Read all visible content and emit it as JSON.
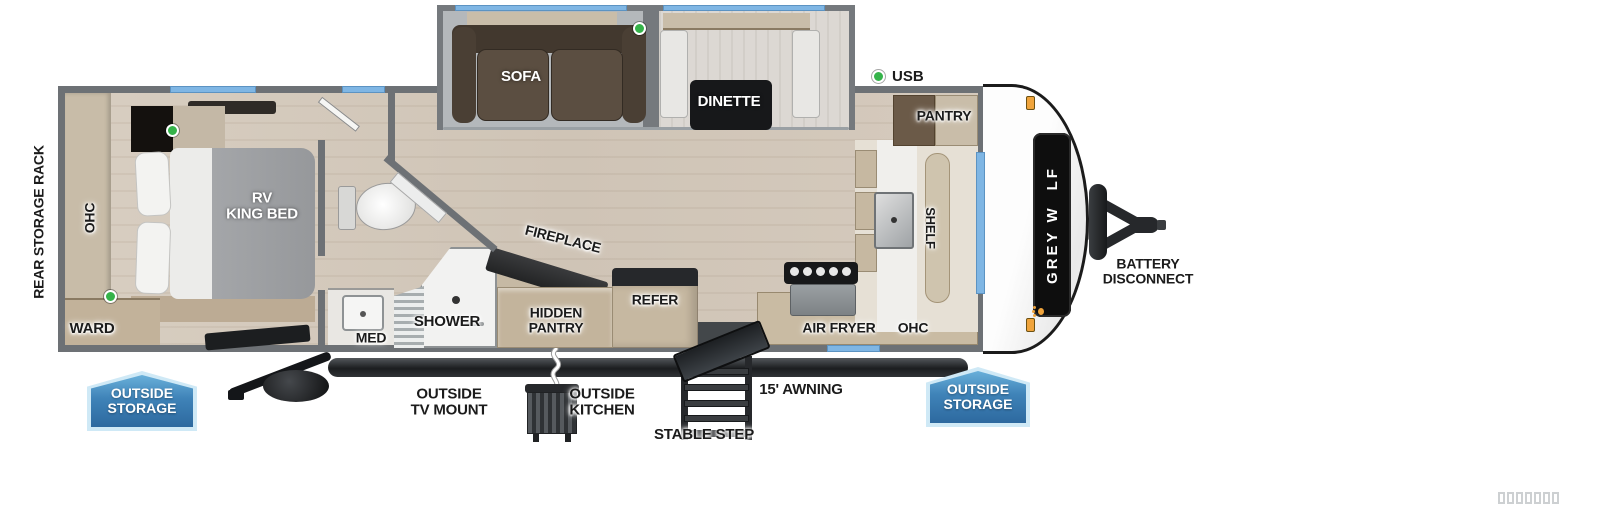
{
  "labels": {
    "rear_storage_rack": "REAR STORAGE RACK",
    "bedroom_ohc": "OHC",
    "ward": "WARD",
    "rv_king_bed": "RV\nKING BED",
    "sofa": "SOFA",
    "dinette": "DINETTE",
    "fireplace": "FIREPLACE",
    "hidden_pantry": "HIDDEN\nPANTRY",
    "refer": "REFER",
    "shower": "SHOWER",
    "med": "MED",
    "usb": "USB",
    "pantry": "PANTRY",
    "shelf": "SHELF",
    "kitchen_ohc": "OHC",
    "air_fryer": "AIR FRYER",
    "battery_disconnect": "BATTERY\nDISCONNECT",
    "outside_storage_left": "OUTSIDE\nSTORAGE",
    "outside_storage_right": "OUTSIDE\nSTORAGE",
    "outside_tv_mount": "OUTSIDE\nTV MOUNT",
    "outside_kitchen": "OUTSIDE\nKITCHEN",
    "stable_step": "STABLE STEP",
    "awning": "15' AWNING"
  },
  "brand": {
    "prefix": "GREY W",
    "suffix": "LF",
    "paw_color": "#f0a43c"
  },
  "colors": {
    "wall": "#6d7175",
    "window_blue": "#7fb6e4",
    "badge_blue": "#2d699f",
    "green_indicator": "#35b34a",
    "floor_wood": "#d3c8bb",
    "cabinet_tan": "#c6b8a1",
    "brand_orange": "#f0a43c"
  },
  "indicators": {
    "green_dot_count": 4
  },
  "watermark": {
    "boxes": 7
  }
}
